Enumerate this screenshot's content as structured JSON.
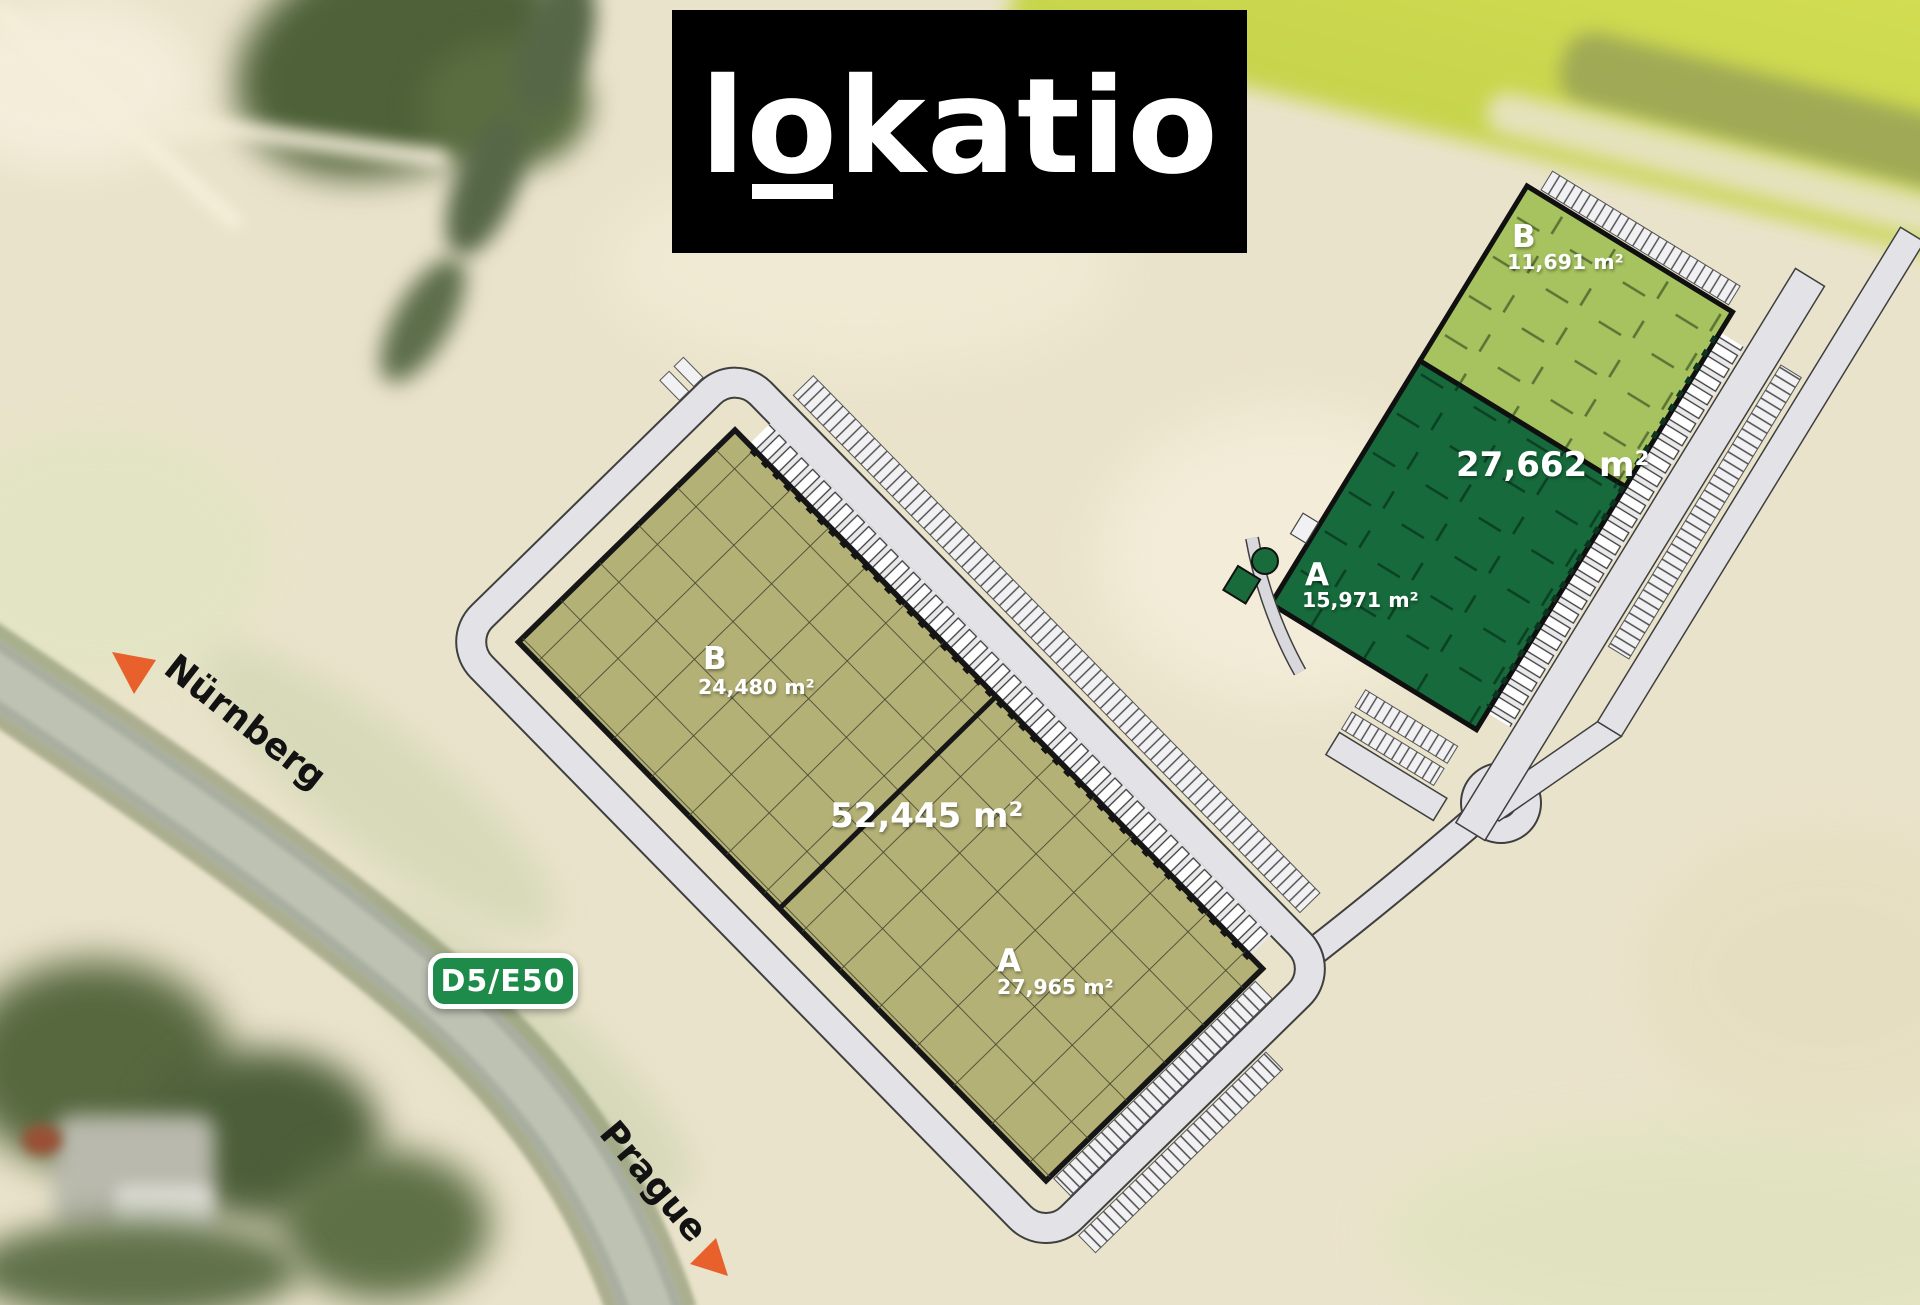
{
  "logo": {
    "pre": "l",
    "o": "o",
    "rest": "katio"
  },
  "road_labels": {
    "west_destination": "Nürnberg",
    "south_destination": "Prague",
    "sign": "D5/E50"
  },
  "buildings": {
    "olive": {
      "total": "52,445 m²",
      "b_letter": "B",
      "b_area": "24,480 m²",
      "a_letter": "A",
      "a_area": "27,965 m²"
    },
    "green": {
      "total": "27,662 m²",
      "b_letter": "B",
      "b_area": "11,691 m²",
      "a_letter": "A",
      "a_area": "15,971 m²"
    }
  },
  "colors": {
    "site_olive": "#b4b176",
    "site_green_light": "#a7c35f",
    "site_green_dark": "#166a3b",
    "road_gray": "#e3e3e7",
    "road_sign_green": "#1f8b4a",
    "arrow_orange": "#e8612c",
    "logo_bg": "#000000",
    "logo_fg": "#ffffff",
    "label_text": "#ffffff"
  }
}
